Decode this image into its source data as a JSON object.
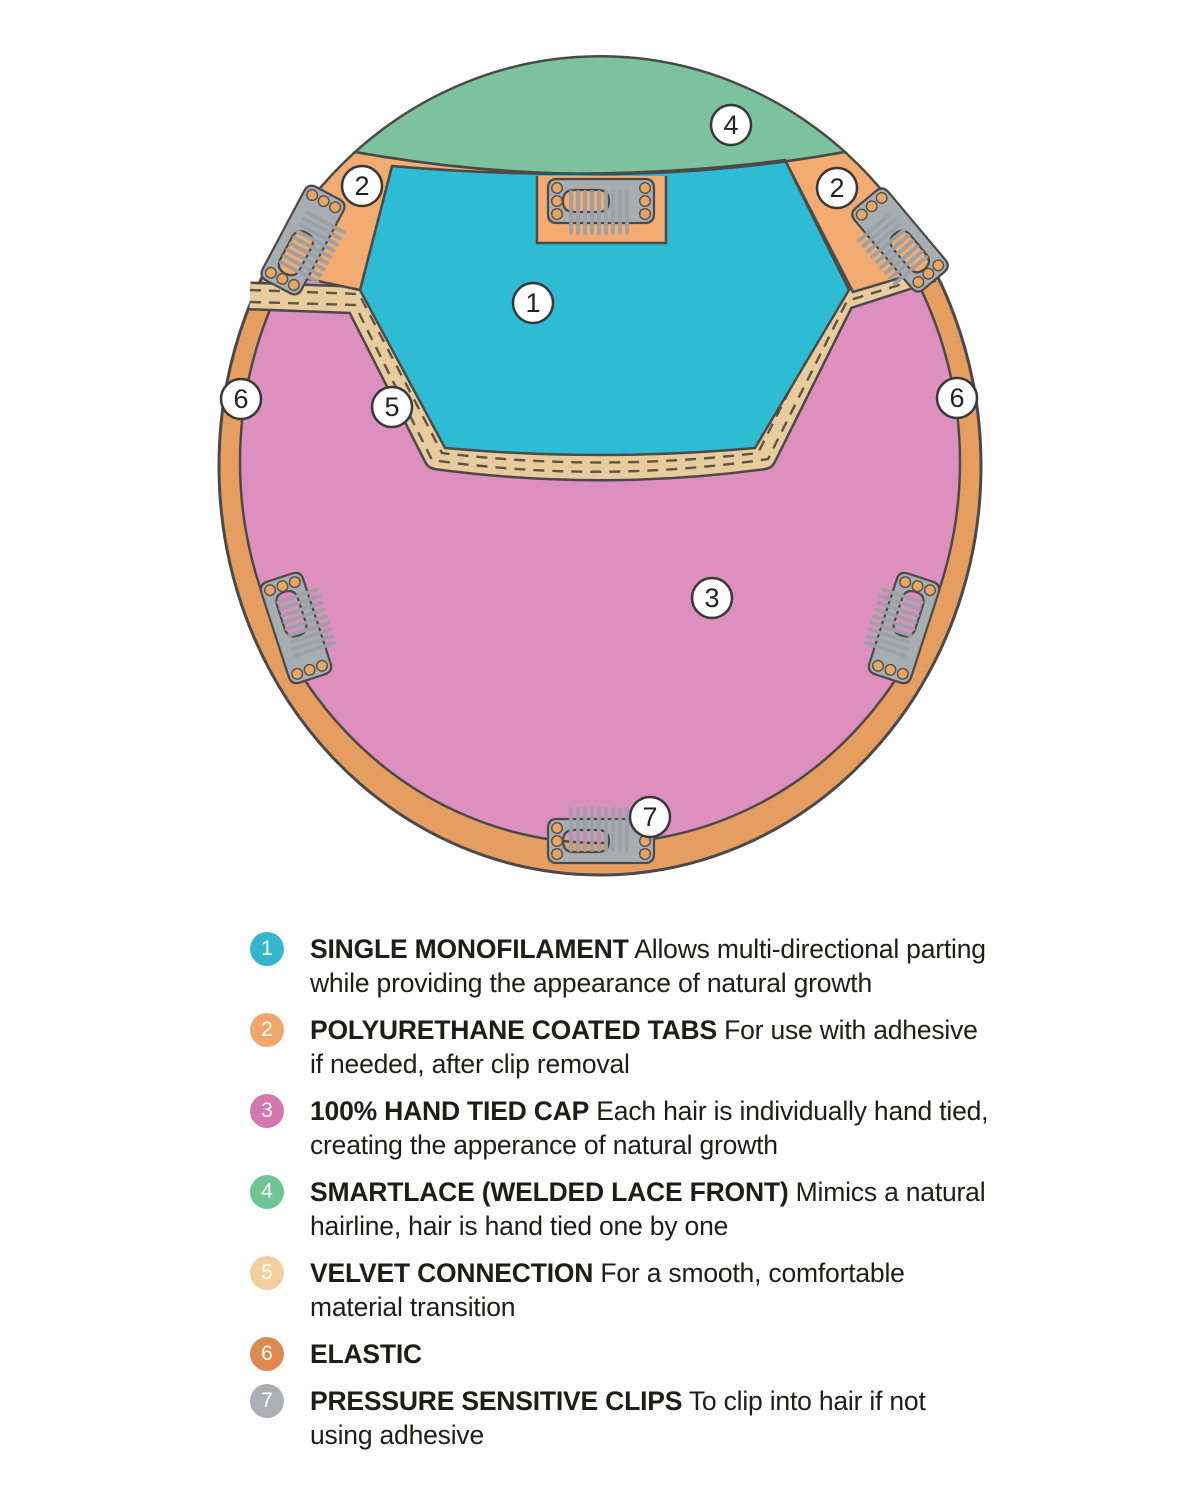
{
  "diagram": {
    "markers": [
      {
        "label": "1"
      },
      {
        "label": "2"
      },
      {
        "label": "2"
      },
      {
        "label": "3"
      },
      {
        "label": "4"
      },
      {
        "label": "5"
      },
      {
        "label": "6"
      },
      {
        "label": "6"
      },
      {
        "label": "7"
      }
    ]
  },
  "colors": {
    "monofilament": "#2EBCD5",
    "tabs": "#F2AC72",
    "hand_tied_cap": "#DD8FBE",
    "smartlace": "#7CC29D",
    "velvet": "#E9CC9E",
    "elastic": "#E69E60",
    "clip_body": "#A8ADB2",
    "clip_teeth": "#9BA1A6",
    "outline": "#4a4a4a"
  },
  "legend": {
    "items": [
      {
        "num": "1",
        "color": "#36B6CE",
        "label": "SINGLE MONOFILAMENT",
        "desc_line1": "Allows multi-directional parting",
        "desc_line2": "while providing the appearance of natural growth"
      },
      {
        "num": "2",
        "color": "#F0A76B",
        "label": "POLYURETHANE COATED TABS",
        "desc_line1": "For use with adhesive",
        "desc_line2": "if needed, after clip removal"
      },
      {
        "num": "3",
        "color": "#D378AE",
        "label": "100% HAND TIED CAP",
        "desc_line1": "Each hair is individually hand tied,",
        "desc_line2": "creating the apperance of natural growth"
      },
      {
        "num": "4",
        "color": "#6FC596",
        "label": "SMARTLACE (WELDED LACE FRONT)",
        "desc_line1": "Mimics a natural",
        "desc_line2": "hairline, hair is hand tied one by one"
      },
      {
        "num": "5",
        "color": "#F3CFA0",
        "label": "VELVET CONNECTION",
        "desc_line1": "For a smooth, comfortable",
        "desc_line2": "material transition"
      },
      {
        "num": "6",
        "color": "#DB8B52",
        "label": "ELASTIC",
        "desc_line1": "",
        "desc_line2": ""
      },
      {
        "num": "7",
        "color": "#ABAEB3",
        "label": "PRESSURE SENSITIVE CLIPS",
        "desc_line1": "To clip into hair if not",
        "desc_line2": "using adhesive"
      }
    ]
  }
}
